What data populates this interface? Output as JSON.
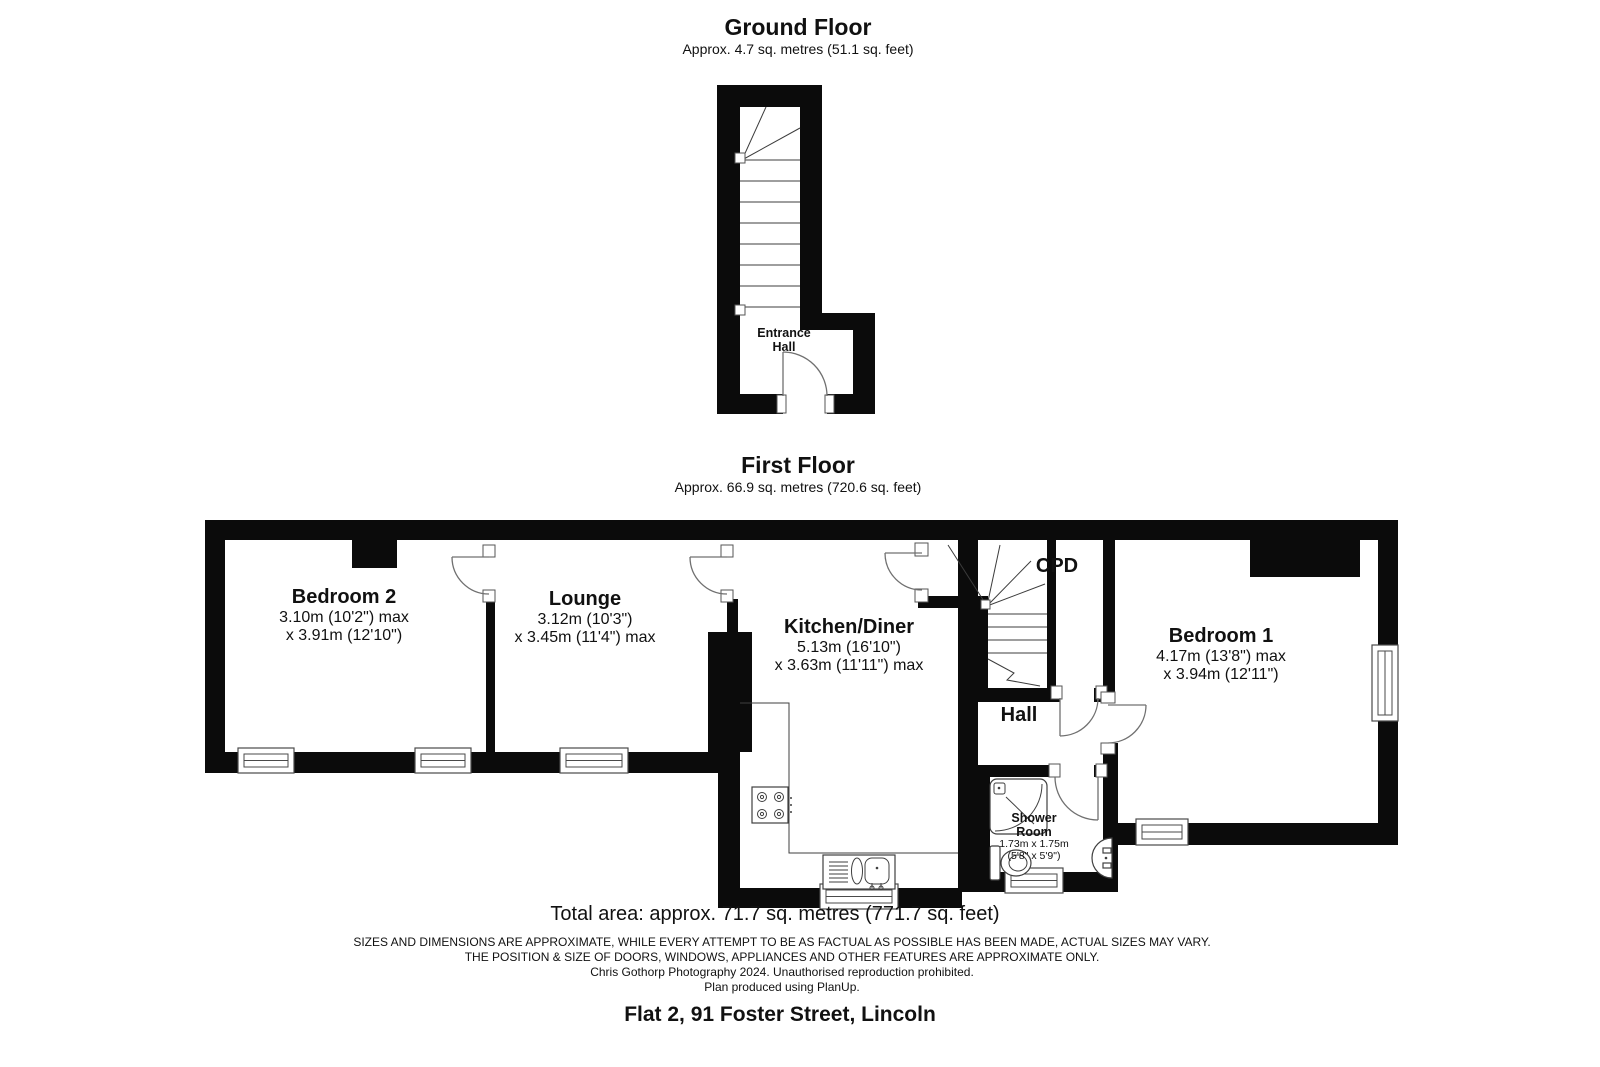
{
  "colors": {
    "wall": "#0b0b0b",
    "background": "#ffffff"
  },
  "ground_floor": {
    "title": "Ground Floor",
    "subtitle": "Approx. 4.7 sq. metres (51.1 sq. feet)",
    "rooms": {
      "entrance_hall": {
        "name_line1": "Entrance",
        "name_line2": "Hall"
      }
    }
  },
  "first_floor": {
    "title": "First Floor",
    "subtitle": "Approx. 66.9 sq. metres (720.6 sq. feet)",
    "rooms": {
      "bedroom2": {
        "name": "Bedroom 2",
        "dim1": "3.10m (10'2\") max",
        "dim2": "x 3.91m (12'10\")"
      },
      "lounge": {
        "name": "Lounge",
        "dim1": "3.12m (10'3\")",
        "dim2": "x 3.45m (11'4\") max"
      },
      "kitchen": {
        "name": "Kitchen/Diner",
        "dim1": "5.13m (16'10\")",
        "dim2": "x 3.63m (11'11\") max"
      },
      "bedroom1": {
        "name": "Bedroom 1",
        "dim1": "4.17m (13'8\") max",
        "dim2": "x 3.94m (12'11\")"
      },
      "cpd": {
        "name": "CPD"
      },
      "hall": {
        "name": "Hall"
      },
      "shower": {
        "name_line1": "Shower",
        "name_line2": "Room",
        "dim1": "1.73m x 1.75m",
        "dim2": "(5'8\" x 5'9\")"
      }
    }
  },
  "footer": {
    "total_area": "Total area: approx. 71.7 sq. metres (771.7 sq. feet)",
    "disclaimer1": "SIZES AND DIMENSIONS ARE APPROXIMATE, WHILE EVERY ATTEMPT TO BE AS FACTUAL AS POSSIBLE HAS BEEN MADE, ACTUAL SIZES MAY VARY.",
    "disclaimer2": "THE POSITION & SIZE OF DOORS, WINDOWS, APPLIANCES AND OTHER FEATURES ARE APPROXIMATE ONLY.",
    "credit": "Chris Gothorp Photography 2024. Unauthorised reproduction prohibited.",
    "software": "Plan produced using PlanUp.",
    "address": "Flat 2, 91 Foster Street, Lincoln"
  }
}
